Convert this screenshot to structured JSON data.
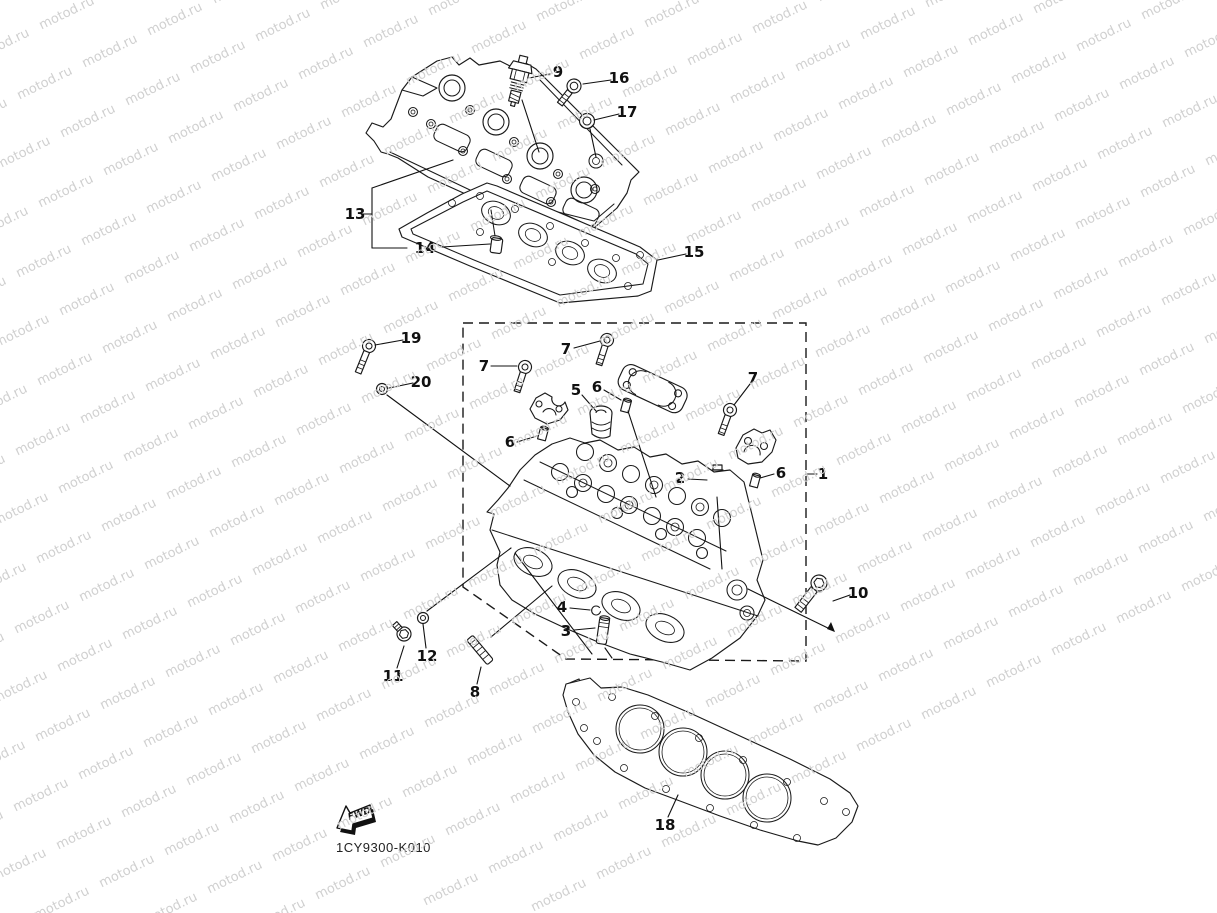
{
  "watermark": {
    "text": "motod.ru",
    "color": "#d0d0d0",
    "font_size": 13,
    "angle_deg": -26,
    "origin": [
      40,
      25
    ],
    "col_step": [
      65,
      -32
    ],
    "row_step": [
      -22,
      70
    ],
    "cols": 27,
    "rows": 20
  },
  "footer": {
    "part_code": "1CY9300-K010",
    "fwd_label": "FWD"
  },
  "style": {
    "line_color": "#1a1a1a",
    "label_color": "#111111"
  },
  "callouts": [
    {
      "label": "1",
      "x": 823,
      "y": 474,
      "lines": [
        [
          806,
          474,
          817,
          474
        ]
      ]
    },
    {
      "label": "2",
      "x": 680,
      "y": 478,
      "lines": [
        [
          688,
          479,
          707,
          480
        ]
      ]
    },
    {
      "label": "3",
      "x": 566,
      "y": 631,
      "lines": [
        [
          574,
          630,
          595,
          628
        ]
      ]
    },
    {
      "label": "4",
      "x": 562,
      "y": 607,
      "lines": [
        [
          570,
          608,
          590,
          610
        ]
      ]
    },
    {
      "label": "5",
      "x": 576,
      "y": 390,
      "lines": [
        [
          582,
          395,
          596,
          411
        ]
      ]
    },
    {
      "label": "6",
      "x": 510,
      "y": 442,
      "lines": [
        [
          517,
          442,
          537,
          436
        ]
      ]
    },
    {
      "label": "6",
      "x": 597,
      "y": 387,
      "lines": [
        [
          604,
          390,
          621,
          400
        ]
      ]
    },
    {
      "label": "6",
      "x": 781,
      "y": 473,
      "lines": [
        [
          774,
          474,
          760,
          478
        ]
      ]
    },
    {
      "label": "7",
      "x": 484,
      "y": 366,
      "lines": [
        [
          491,
          366,
          517,
          366
        ]
      ]
    },
    {
      "label": "7",
      "x": 566,
      "y": 349,
      "lines": [
        [
          574,
          348,
          600,
          341
        ]
      ]
    },
    {
      "label": "7",
      "x": 753,
      "y": 378,
      "lines": [
        [
          750,
          384,
          734,
          405
        ]
      ]
    },
    {
      "label": "8",
      "x": 475,
      "y": 692,
      "lines": [
        [
          477,
          684,
          481,
          667
        ]
      ]
    },
    {
      "label": "9",
      "x": 558,
      "y": 72,
      "lines": [
        [
          550,
          74,
          529,
          78
        ]
      ]
    },
    {
      "label": "10",
      "x": 858,
      "y": 593,
      "lines": [
        [
          850,
          595,
          833,
          601
        ]
      ]
    },
    {
      "label": "11",
      "x": 393,
      "y": 676,
      "lines": [
        [
          397,
          668,
          404,
          646
        ]
      ]
    },
    {
      "label": "12",
      "x": 427,
      "y": 656,
      "lines": [
        [
          426,
          648,
          423,
          624
        ]
      ]
    },
    {
      "label": "13",
      "x": 355,
      "y": 214,
      "lines": [
        [
          363,
          214,
          372,
          214
        ],
        [
          372,
          188,
          372,
          248
        ],
        [
          372,
          188,
          453,
          160
        ],
        [
          372,
          248,
          407,
          248
        ]
      ]
    },
    {
      "label": "14",
      "x": 425,
      "y": 248,
      "lines": [
        [
          442,
          247,
          490,
          244
        ]
      ]
    },
    {
      "label": "15",
      "x": 694,
      "y": 252,
      "lines": [
        [
          686,
          254,
          658,
          260
        ]
      ]
    },
    {
      "label": "16",
      "x": 619,
      "y": 78,
      "lines": [
        [
          611,
          80,
          583,
          84
        ]
      ]
    },
    {
      "label": "17",
      "x": 627,
      "y": 112,
      "lines": [
        [
          619,
          114,
          594,
          120
        ]
      ]
    },
    {
      "label": "18",
      "x": 665,
      "y": 825,
      "lines": [
        [
          668,
          817,
          678,
          795
        ]
      ]
    },
    {
      "label": "19",
      "x": 411,
      "y": 338,
      "lines": [
        [
          403,
          340,
          375,
          345
        ]
      ]
    },
    {
      "label": "20",
      "x": 421,
      "y": 382,
      "lines": [
        [
          413,
          383,
          389,
          388
        ]
      ]
    }
  ],
  "assembly_lines": [
    [
      522,
      100,
      539,
      152
    ],
    [
      590,
      129,
      596,
      157
    ],
    [
      387,
      395,
      510,
      486
    ],
    [
      628,
      411,
      656,
      497
    ],
    [
      717,
      497,
      722,
      569
    ],
    [
      748,
      589,
      834,
      631
    ],
    [
      427,
      611,
      511,
      548
    ],
    [
      491,
      637,
      552,
      586
    ],
    [
      515,
      553,
      592,
      654
    ],
    [
      605,
      648,
      612,
      658
    ]
  ]
}
